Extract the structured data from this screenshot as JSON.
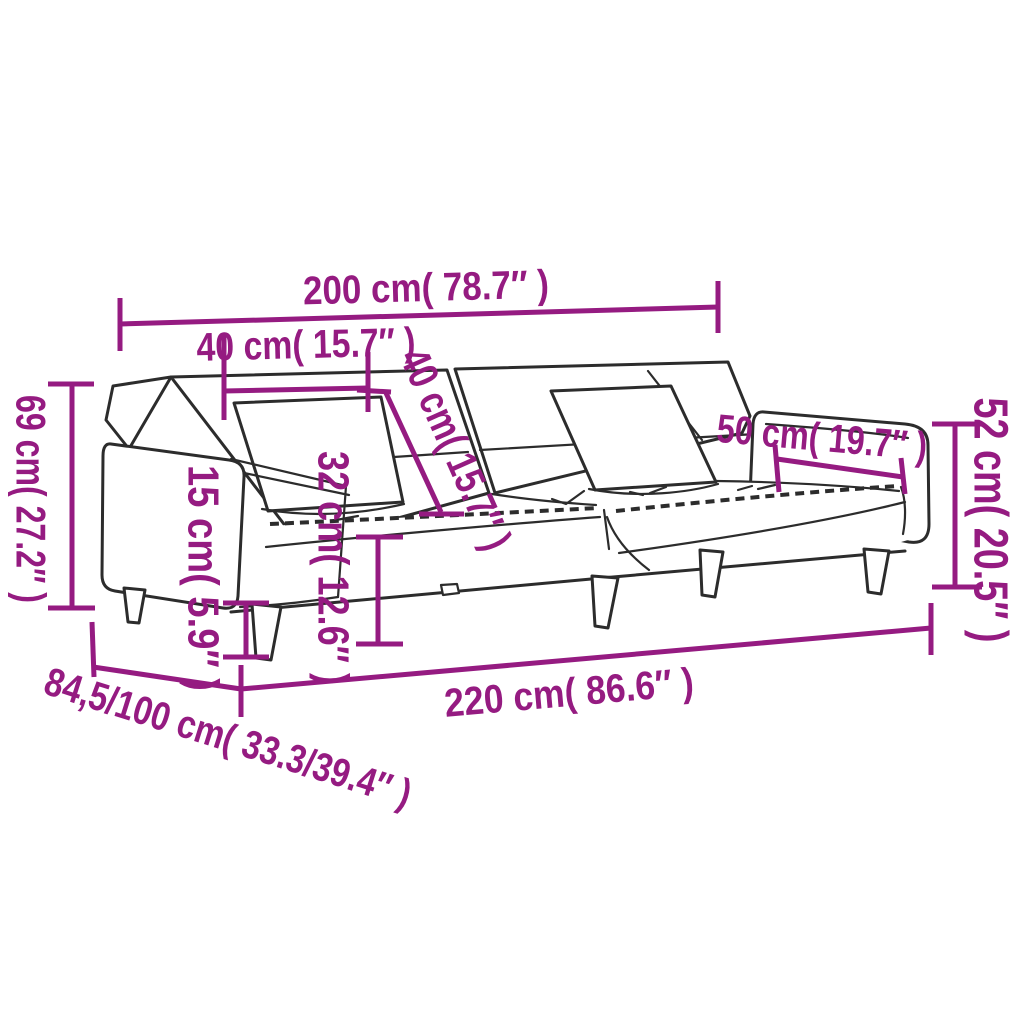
{
  "diagram": {
    "kind": "product-dimension-diagram",
    "illustration": "sofa-bed-line-art",
    "accent_color": "#951b81",
    "outline_color": "#2c2c2c",
    "background_color": "#ffffff",
    "dimensions": {
      "total_width": "200 cm( 78.7″ )",
      "armrest_width": "40 cm( 15.7″ )",
      "pillow_size": "40 cm( 15.7″ )",
      "total_height": "69 cm( 27.2″ )",
      "leg_height": "15 cm( 5.9″ )",
      "seat_height": "32 cm( 12.6″ )",
      "armrest_inner_width": "50 cm( 19.7″ )",
      "backrest_height": "52 cm( 20.5″ )",
      "bed_length": "220 cm( 86.6″ )",
      "depth_range": "84,5/100 cm( 33.3/39.4″ )"
    }
  }
}
